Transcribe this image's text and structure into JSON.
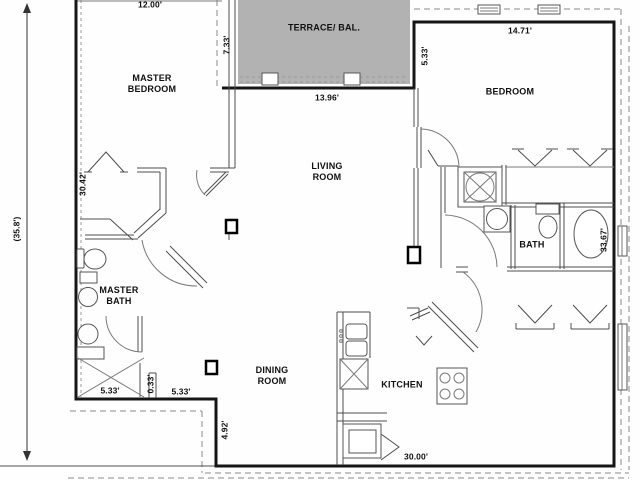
{
  "plan": {
    "title": "Apartment floor plan",
    "background": "#fefefe",
    "colors": {
      "wall": "#161616",
      "interior_wall": "#4d4d4d",
      "dashed_boundary": "#8a8a8a",
      "terrace_fill": "#b2b2b2",
      "text": "#101010"
    },
    "rooms": {
      "master_bedroom": "MASTER\nBEDROOM",
      "bedroom": "BEDROOM",
      "living_room": "LIVING\nROOM",
      "dining_room": "DINING\nROOM",
      "kitchen": "KITCHEN",
      "bath": "BATH",
      "master_bath": "MASTER\nBATH",
      "terrace": "TERRACE/ BAL."
    },
    "dimensions": {
      "top_width": "12.00'",
      "terrace_depth": "7.33'",
      "terrace_width": "13.96'",
      "bedroom_width": "14.71'",
      "bedroom_setback": "5.33'",
      "left_side_upper": "30.42'",
      "overall_left": "(35.8')",
      "bath_side": "33.67'",
      "mbath_width_a": "5.33'",
      "mbath_jog": "0.33'",
      "mbath_width_b": "5.33'",
      "step_depth": "4.92'",
      "bottom_width": "30.00'"
    }
  }
}
